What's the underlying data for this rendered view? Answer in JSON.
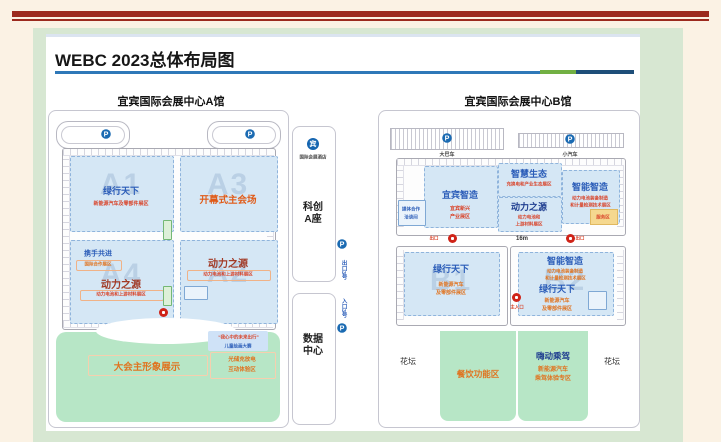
{
  "page": {
    "title": "WEBC 2023总体布局图"
  },
  "icons": {
    "parking": "P",
    "hotel": "宾"
  },
  "halls": {
    "a": {
      "header": "宜宾国际会展中心A馆",
      "gates": {
        "top": "出口",
        "main": "主入口",
        "entrance_left": "入口3号",
        "exit_right": "出口3号"
      },
      "zones": {
        "a1": {
          "code": "A1",
          "title": "绿行天下",
          "subtitle": "新能源汽车及零部件展区"
        },
        "a3": {
          "code": "A3",
          "title": "开幕式主会场"
        },
        "a4": {
          "code": "A4",
          "small_title": "携手共进",
          "small_subtitle": "国际合作展区",
          "title": "动力之源",
          "subtitle": "动力电池和上游材料展区"
        },
        "a2": {
          "code": "A2",
          "title": "动力之源",
          "subtitle": "动力电池和上游材料展区"
        }
      },
      "lawn": {
        "main": "大会主形象展示",
        "exp_line1": "光储充放电",
        "exp_line2": "互动体验区",
        "kids_line1": "“我心中的未来出行”",
        "kids_line2": "儿童绘画大赛"
      }
    },
    "center": {
      "hotel_caption": "国际会展酒店",
      "tower_line1": "科创",
      "tower_line2": "A座",
      "data_line1": "数据",
      "data_line2": "中心",
      "exit_label": "出口3号",
      "entrance_label": "入口3号"
    },
    "b": {
      "header": "宜宾国际会展中心B馆",
      "parking_bus": "大巴车",
      "parking_car": "小汽车",
      "b3": {
        "code": "B3",
        "yibin": {
          "title": "宜宾智造",
          "sub1": "宜宾新兴",
          "sub2": "产业展区"
        },
        "smart_eco": {
          "title": "智慧生态",
          "sub": "充换电和产业生态展区"
        },
        "power": {
          "title": "动力之源",
          "sub1": "动力电池和",
          "sub2": "上游材料展区"
        },
        "intelligent": {
          "title": "智能智造",
          "sub1": "动力电池装备制造",
          "sub2": "和计量检测技术展区"
        },
        "media_line1": "媒体合作",
        "media_line2": "洽谈间",
        "service": "服务区"
      },
      "mid": {
        "exit": "出口",
        "width": "16m",
        "main_gate": "主入口"
      },
      "b1": {
        "code": "B1",
        "title": "绿行天下",
        "sub1": "新能源汽车",
        "sub2": "及零部件展区"
      },
      "b2": {
        "code": "B2",
        "title1": "智能智造",
        "t1sub1": "动力电池装备制造",
        "t1sub2": "和计量检测技术展区",
        "title2": "绿行天下",
        "t2sub1": "新能源汽车",
        "t2sub2": "及零部件展区"
      },
      "lawn": {
        "flowerbed_left": "花坛",
        "flowerbed_right": "花坛",
        "dining": "餐饮功能区",
        "drive_title": "嗨动乘驾",
        "drive_sub1": "新能源汽车",
        "drive_sub2": "乘驾体验专区"
      }
    }
  }
}
